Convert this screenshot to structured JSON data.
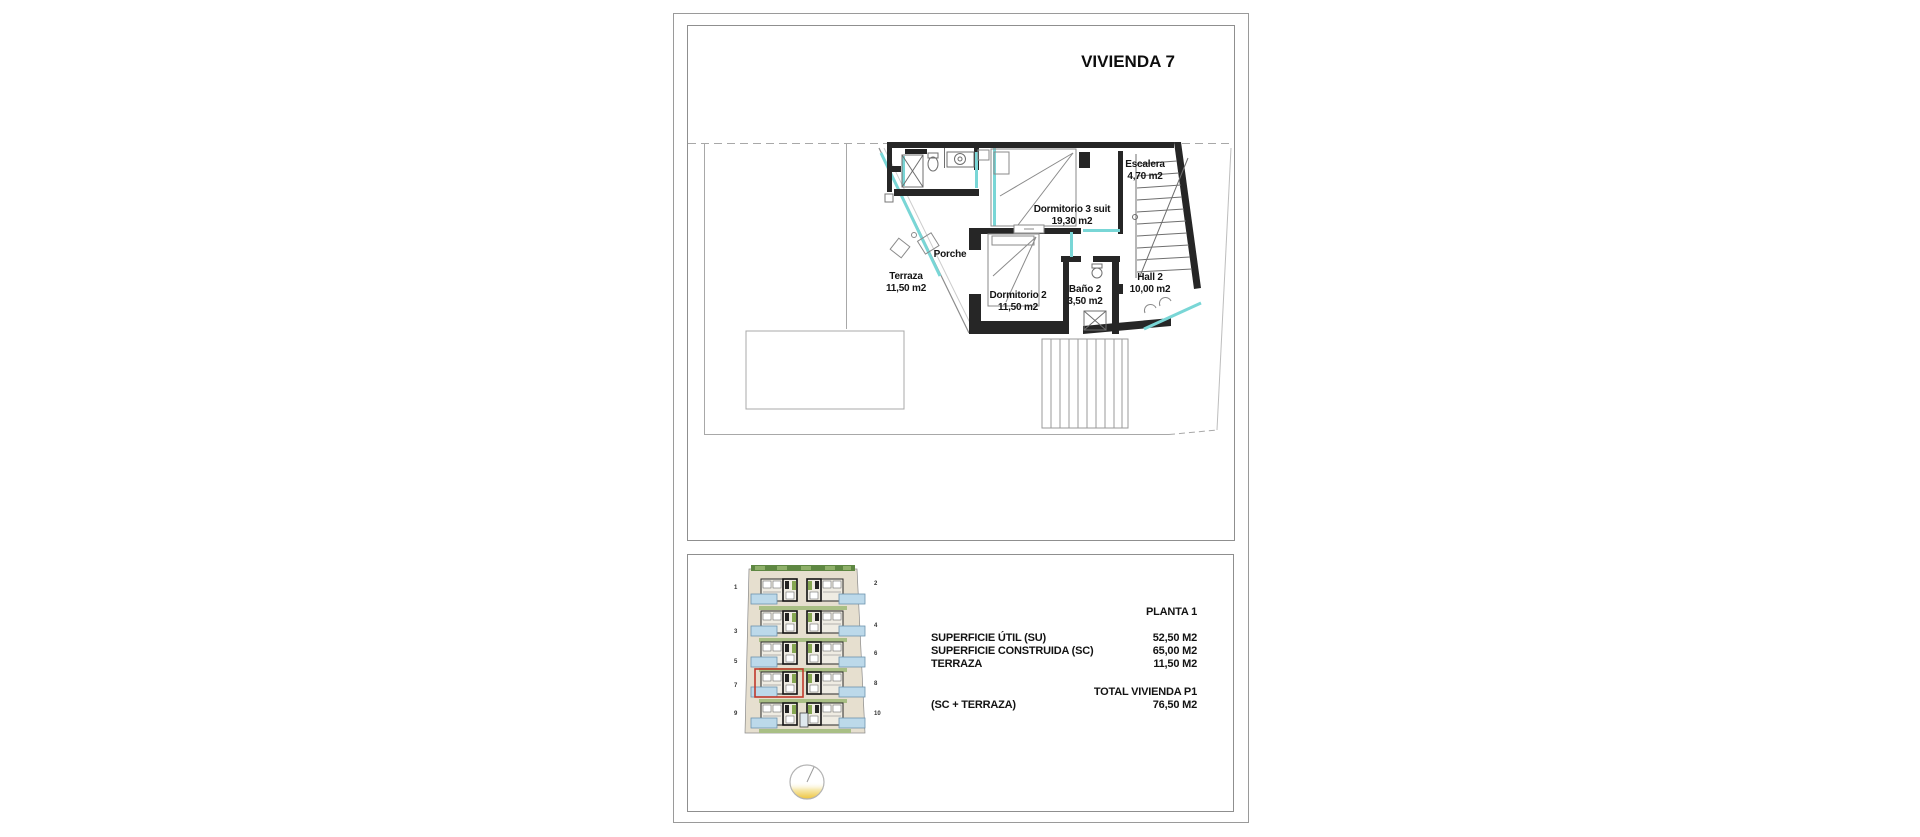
{
  "plan_sheet": {
    "title": "VIVIENDA 7",
    "rooms": [
      {
        "name": "Escalera",
        "area": "4,70 m2"
      },
      {
        "name": "Dormitorio 3 suit",
        "area": "19,30 m2"
      },
      {
        "name": "Porche",
        "area": ""
      },
      {
        "name": "Terraza",
        "area": "11,50 m2"
      },
      {
        "name": "Dormitorio 2",
        "area": "11,50 m2"
      },
      {
        "name": "Baño 2",
        "area": "3,50 m2"
      },
      {
        "name": "Hall 2",
        "area": "10,00 m2"
      }
    ]
  },
  "summary": {
    "floor_label": "PLANTA 1",
    "rows": [
      {
        "label": "SUPERFICIE ÚTIL (SU)",
        "value": "52,50 M2"
      },
      {
        "label": "SUPERFICIE CONSTRUIDA (SC)",
        "value": "65,00 M2"
      },
      {
        "label": "TERRAZA",
        "value": "11,50 M2"
      }
    ],
    "total_label": "TOTAL VIVIENDA P1",
    "total_sublabel": "(SC + TERRAZA)",
    "total_value": "76,50 M2"
  },
  "site_plan": {
    "highlighted_unit": "7",
    "left_unit_numbers": [
      "1",
      "3",
      "5",
      "7",
      "9"
    ],
    "right_unit_numbers": [
      "2",
      "4",
      "6",
      "8",
      "10"
    ],
    "colors": {
      "ground": "#e6dfcf",
      "hedge": "#5e8742",
      "lawn": "#a9bf85",
      "pool": "#bcd9ea",
      "pool_border": "#6d93ad",
      "highlight": "#c0392b"
    }
  },
  "plan_colors": {
    "wall": "#262626",
    "window_glazing": "#79d6d6",
    "plot_boundary": "#a8a8a8"
  }
}
